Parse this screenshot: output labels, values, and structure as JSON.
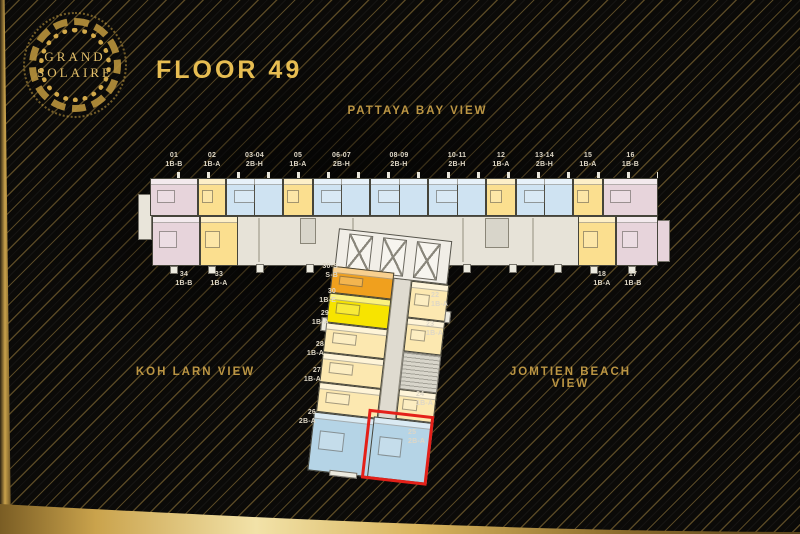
{
  "logo": {
    "line1": "GRAND",
    "line2": "SOLAIRE"
  },
  "title": "FLOOR 49",
  "views": {
    "top": "PATTAYA BAY VIEW",
    "left": "KOH LARN VIEW",
    "right": "JOMTIEN BEACH VIEW"
  },
  "colors": {
    "pink": "#e7d4db",
    "yellow": "#fbdf8f",
    "blue": "#cfe3f2",
    "cream": "#fce8b0",
    "orange": "#f0a01e",
    "bright_yellow": "#f7e400",
    "light_blue": "#b5d4e6",
    "corridor": "#e7e3d8",
    "core": "#f1eee7",
    "service": "#d8d5ca",
    "highlight": "#e42019",
    "gold": "#e7bd52",
    "view_label": "#bb9543",
    "unit_label": "#ded7c6"
  },
  "plan": {
    "bar_top": [
      {
        "no": "01",
        "type": "1B-B"
      },
      {
        "no": "02",
        "type": "1B-A"
      },
      {
        "no": "03-04",
        "type": "2B-H"
      },
      {
        "no": "05",
        "type": "1B-A"
      },
      {
        "no": "06-07",
        "type": "2B-H"
      },
      {
        "no": "08-09",
        "type": "2B-H"
      },
      {
        "no": "10-11",
        "type": "2B-H"
      },
      {
        "no": "12",
        "type": "1B-A"
      },
      {
        "no": "13-14",
        "type": "2B-H"
      },
      {
        "no": "15",
        "type": "1B-A"
      },
      {
        "no": "16",
        "type": "1B-B"
      }
    ],
    "bar_bottom_left": [
      {
        "no": "34",
        "type": "1B-B"
      },
      {
        "no": "33",
        "type": "1B-A"
      }
    ],
    "bar_bottom_right": [
      {
        "no": "18",
        "type": "1B-A"
      },
      {
        "no": "17",
        "type": "1B-B"
      }
    ],
    "stem_left": [
      {
        "no": "30-S",
        "type": "S-B"
      },
      {
        "no": "30",
        "type": "1B-E"
      },
      {
        "no": "29",
        "type": "1B-A"
      },
      {
        "no": "28",
        "type": "1B-A"
      },
      {
        "no": "27",
        "type": "1B-A"
      },
      {
        "no": "26",
        "type": "2B-A"
      }
    ],
    "stem_right": [
      {
        "no": "22",
        "type": "1B-A"
      },
      {
        "no": "23",
        "type": "1B-A"
      },
      {
        "no": "24",
        "type": "1B-A"
      },
      {
        "no": "25",
        "type": "2B-A"
      }
    ],
    "highlighted_unit": {
      "no": "25",
      "type": "2B-A"
    }
  }
}
